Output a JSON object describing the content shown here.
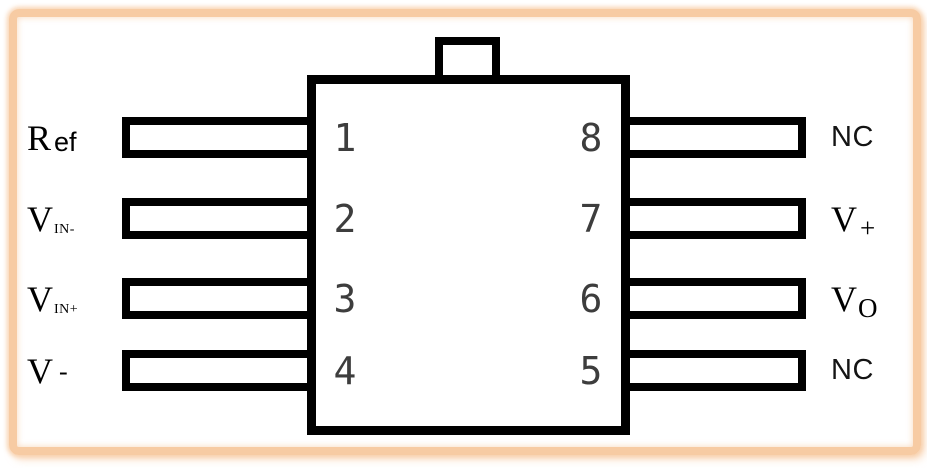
{
  "diagram": {
    "colors": {
      "frame": "#F7CBA3",
      "line": "#000000",
      "pin_number": "#3D3D3D"
    },
    "pins": {
      "left": [
        {
          "number": "1",
          "label_main": "R",
          "label_sub": "ef"
        },
        {
          "number": "2",
          "label_main": "V",
          "label_sub": "IN-"
        },
        {
          "number": "3",
          "label_main": "V",
          "label_sub": "IN+"
        },
        {
          "number": "4",
          "label_main": "V",
          "label_sub": "-"
        }
      ],
      "right": [
        {
          "number": "8",
          "label_main": "NC",
          "label_sub": ""
        },
        {
          "number": "7",
          "label_main": "V",
          "label_sub": "+"
        },
        {
          "number": "6",
          "label_main": "V",
          "label_sub": "O"
        },
        {
          "number": "5",
          "label_main": "NC",
          "label_sub": ""
        }
      ]
    }
  }
}
